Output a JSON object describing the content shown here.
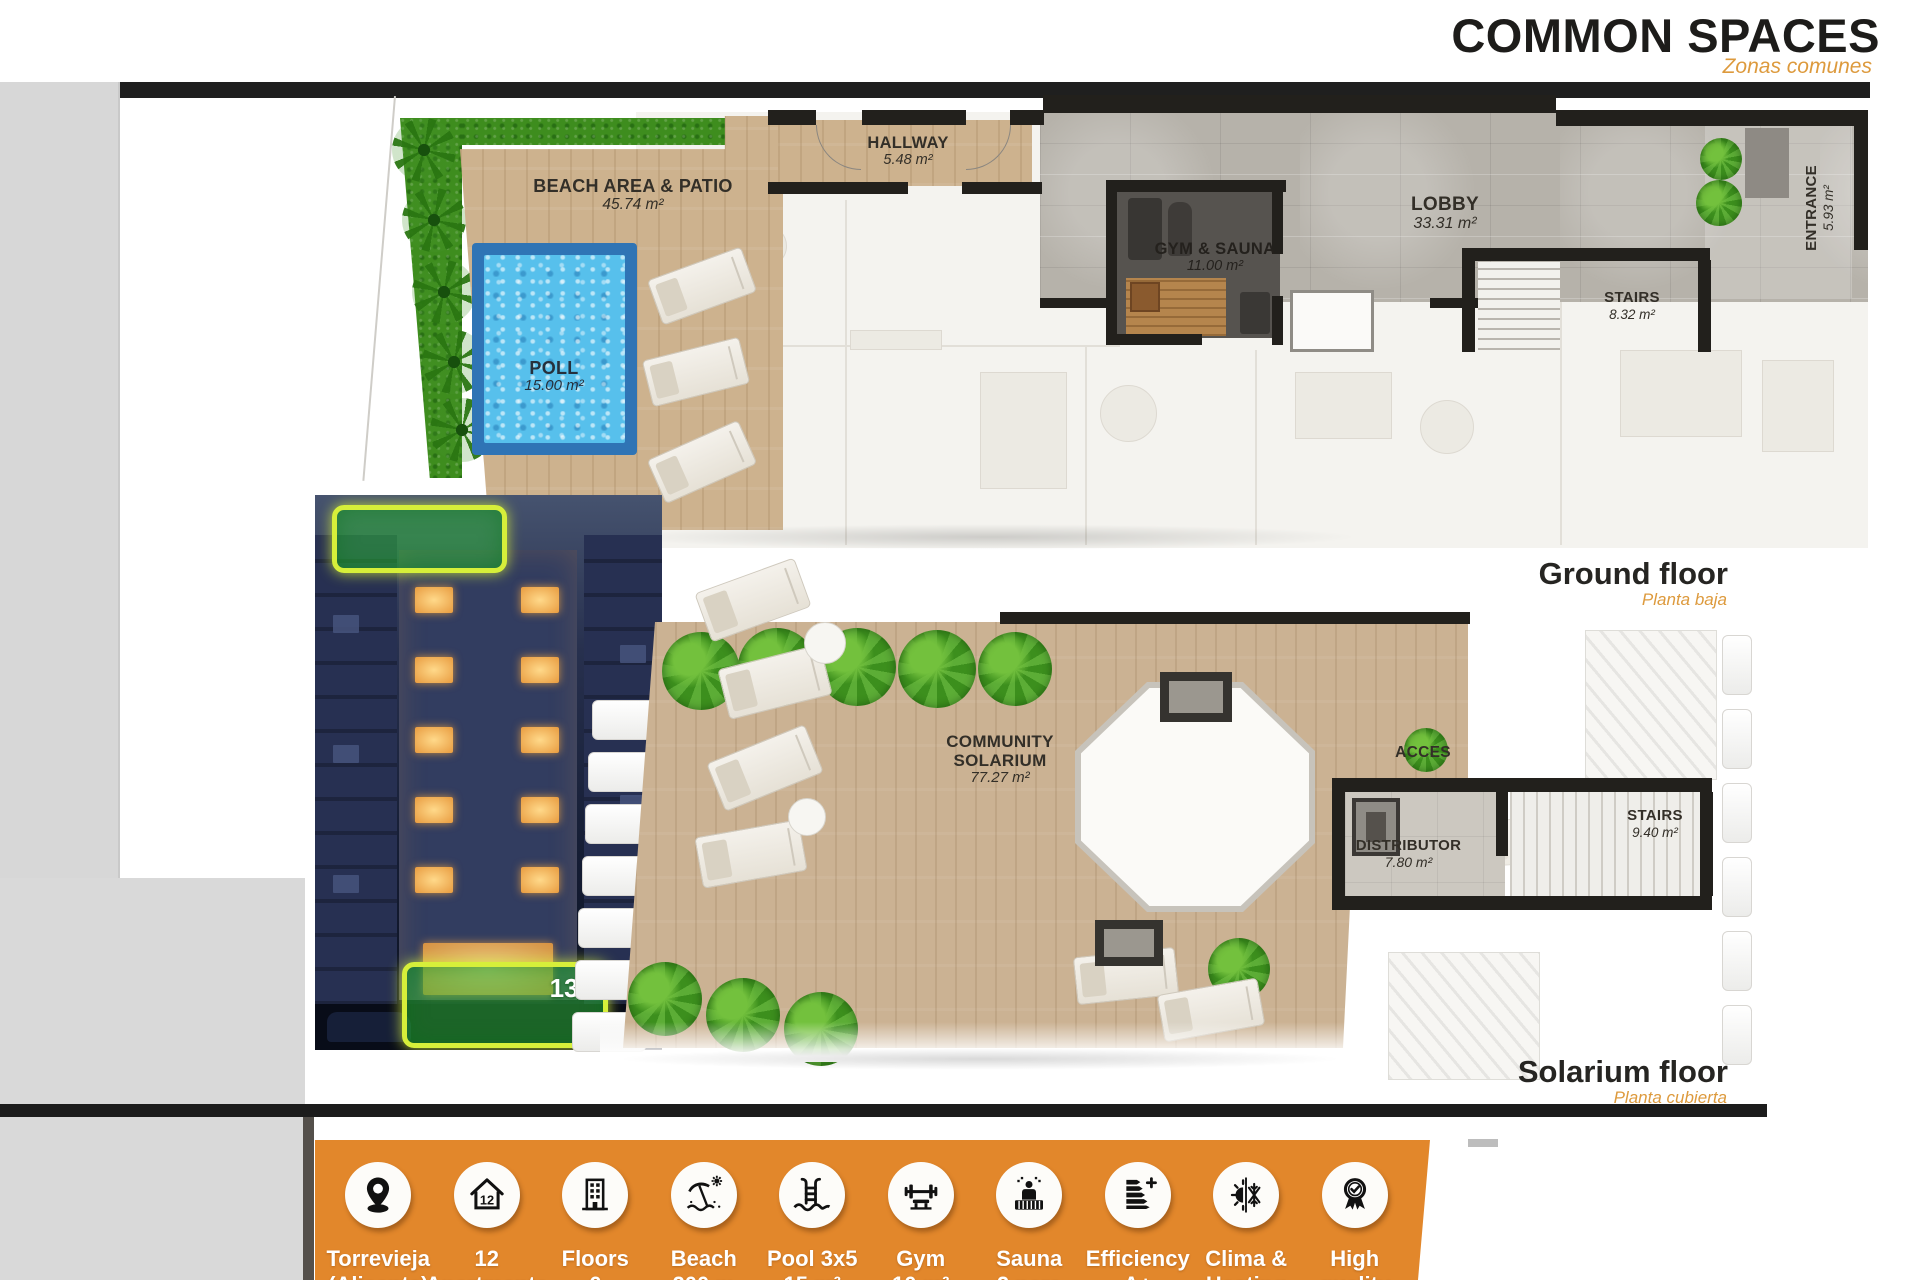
{
  "header": {
    "title": "COMMON SPACES",
    "subtitle": "Zonas comunes"
  },
  "ground_floor": {
    "caption": "Ground floor",
    "caption_sub": "Planta baja",
    "rooms": [
      {
        "name": "BEACH AREA & PATIO",
        "area": "45.74 m²"
      },
      {
        "name": "HALLWAY",
        "area": "5.48 m²"
      },
      {
        "name": "POLL",
        "area": "15.00 m²"
      },
      {
        "name": "GYM & SAUNA",
        "area": "11.00 m²"
      },
      {
        "name": "LOBBY",
        "area": "33.31 m²"
      },
      {
        "name": "STAIRS",
        "area": "8.32 m²"
      },
      {
        "name": "ENTRANCE",
        "area": "5.93 m²"
      }
    ]
  },
  "solarium_floor": {
    "caption": "Solarium floor",
    "caption_sub": "Planta cubierta",
    "rooms": [
      {
        "name": "COMMUNITY SOLARIUM",
        "area": "77.27 m²"
      },
      {
        "name": "ACCES",
        "area": ""
      },
      {
        "name": "DISTRIBUTOR",
        "area": "7.80 m²"
      },
      {
        "name": "STAIRS",
        "area": "9.40 m²"
      }
    ]
  },
  "building_photo": {
    "highlight_badge": "132"
  },
  "features": [
    {
      "icon": "location-pin",
      "line1": "Torrevieja",
      "line2": "(Alicante)"
    },
    {
      "icon": "house-12",
      "icon_label": "12",
      "line1": "12",
      "line2": "Apartments"
    },
    {
      "icon": "building",
      "line1": "Floors",
      "line2": "6"
    },
    {
      "icon": "beach",
      "line1": "Beach",
      "line2": "200 m"
    },
    {
      "icon": "pool",
      "line1": "Pool 3x5",
      "line2": "15 m²"
    },
    {
      "icon": "gym",
      "line1": "Gym",
      "line2": "10 m²"
    },
    {
      "icon": "sauna",
      "line1": "Sauna",
      "line2": "2 pers"
    },
    {
      "icon": "efficiency",
      "line1": "Efficiency",
      "line2": "A+"
    },
    {
      "icon": "climate",
      "line1": "Clima &",
      "line2": "Heating"
    },
    {
      "icon": "award",
      "line1": "High",
      "line2": "quality"
    }
  ],
  "colors": {
    "accent_orange": "#e2872b",
    "subtitle_orange": "#dd9a3d",
    "title_dark": "#1d1c1a",
    "highlight_green": "#2fbe37",
    "highlight_border": "#d6ef3a",
    "pool_water": "#57c0ec",
    "wall_black": "#22201c"
  }
}
